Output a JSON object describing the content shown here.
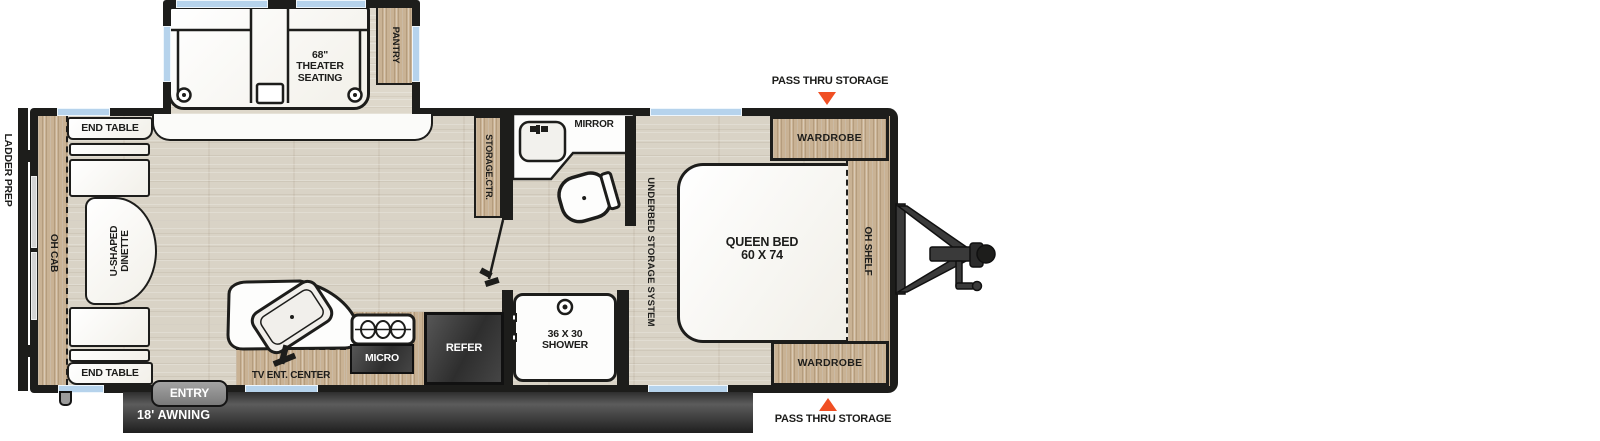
{
  "plan": {
    "labels": {
      "ladder_prep": "LADDER PREP",
      "oh_cab": "OH CAB",
      "end_table_top": "END TABLE",
      "end_table_bottom": "END TABLE",
      "dinette": "U-SHAPED\nDINETTE",
      "theater": "68\"\nTHEATER\nSEATING",
      "pantry": "PANTRY",
      "storage_ctr": "STORAGE.CTR.",
      "mirror": "MIRROR",
      "micro": "MICRO",
      "refer": "REFER",
      "shower": "36 X 30\nSHOWER",
      "tv_ent_center": "TV ENT. CENTER",
      "entry": "ENTRY",
      "awning": "18' AWNING",
      "underbed": "UNDERBED STORAGE SYSTEM",
      "queen_bed": "QUEEN BED\n60 X 74",
      "oh_shelf": "OH SHELF",
      "wardrobe_top": "WARDROBE",
      "wardrobe_bottom": "WARDROBE",
      "pass_thru_top": "PASS THRU STORAGE",
      "pass_thru_bottom": "PASS THRU STORAGE"
    },
    "colors": {
      "wall": "#1d1d1b",
      "wood": "#c9b294",
      "floor": "#d9d3c6",
      "window": "#b6d3ec",
      "rear_window": "#d4d4d4",
      "appliance_dark": "#3c3c3c",
      "awning_dark": "#2f2f2f",
      "accent_orange": "#f04f23",
      "entry_gray": "#8c8c8c"
    }
  }
}
